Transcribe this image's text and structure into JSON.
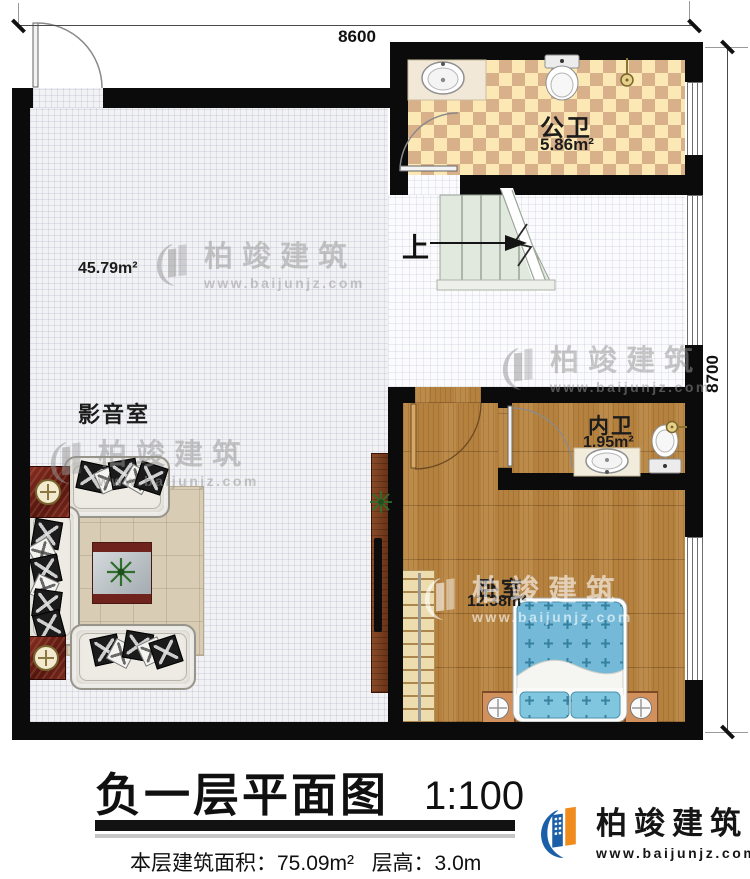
{
  "plan": {
    "dim_top": "8600",
    "dim_right": "8700",
    "up": "上"
  },
  "rooms": {
    "media": {
      "name": "影音室",
      "area": "45.79m²"
    },
    "public_bath": {
      "name": "公卫",
      "area": "5.86m²"
    },
    "inner_bath": {
      "name": "内卫",
      "area": "1.95m²"
    },
    "bedroom": {
      "name": "卧室",
      "area": "12.38m²"
    }
  },
  "title_block": {
    "title": "负一层平面图",
    "scale": "1:100",
    "floor_area": "本层建筑面积：75.09m²",
    "floor_height": "层高：3.0m"
  },
  "brand": {
    "name": "柏竣建筑",
    "url": "www.baijunjz.com"
  },
  "watermark": {
    "name": "柏竣建筑",
    "url": "www.baijunjz.com"
  },
  "colors": {
    "wall": "#0b0b0b",
    "checker_light": "#fce8b4",
    "checker_dark": "#d8b08a",
    "wood": "#b5813f",
    "brand_blue": "#1a5fa8",
    "brand_orange": "#f08c1e"
  }
}
